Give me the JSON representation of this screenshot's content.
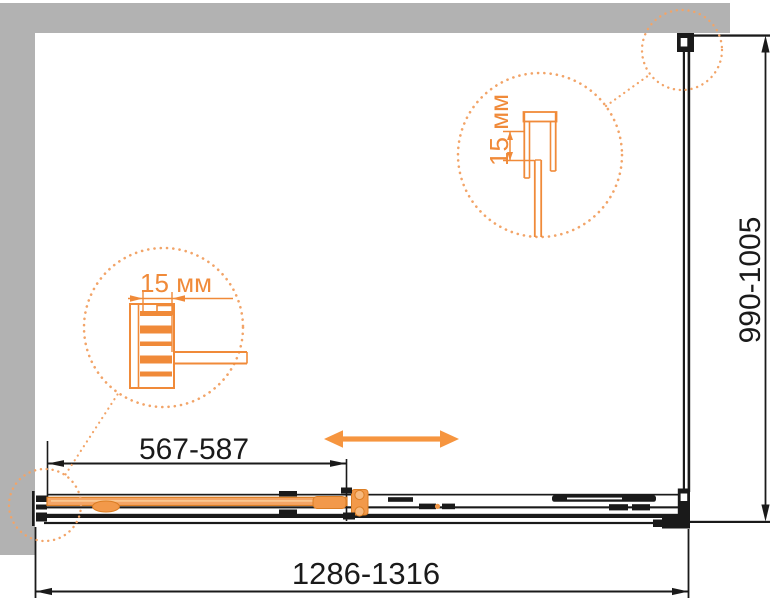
{
  "diagram": {
    "overall_width": "1286-1316",
    "overall_height": "990-1005",
    "door_adjust_width": "567-587",
    "detail_left": {
      "label": "15 мм"
    },
    "detail_right": {
      "label": "15 мм"
    }
  },
  "colors": {
    "wall_gray": "#B2B2B2",
    "line_black": "#1A1A1A",
    "accent_orange": "#F08A39",
    "dots_orange": "#F2A468",
    "arrow_orange": "#F6953F",
    "door_fill_orange": "#F4A566"
  },
  "icons": {
    "slide_direction": "double-headed-arrow-icon"
  }
}
